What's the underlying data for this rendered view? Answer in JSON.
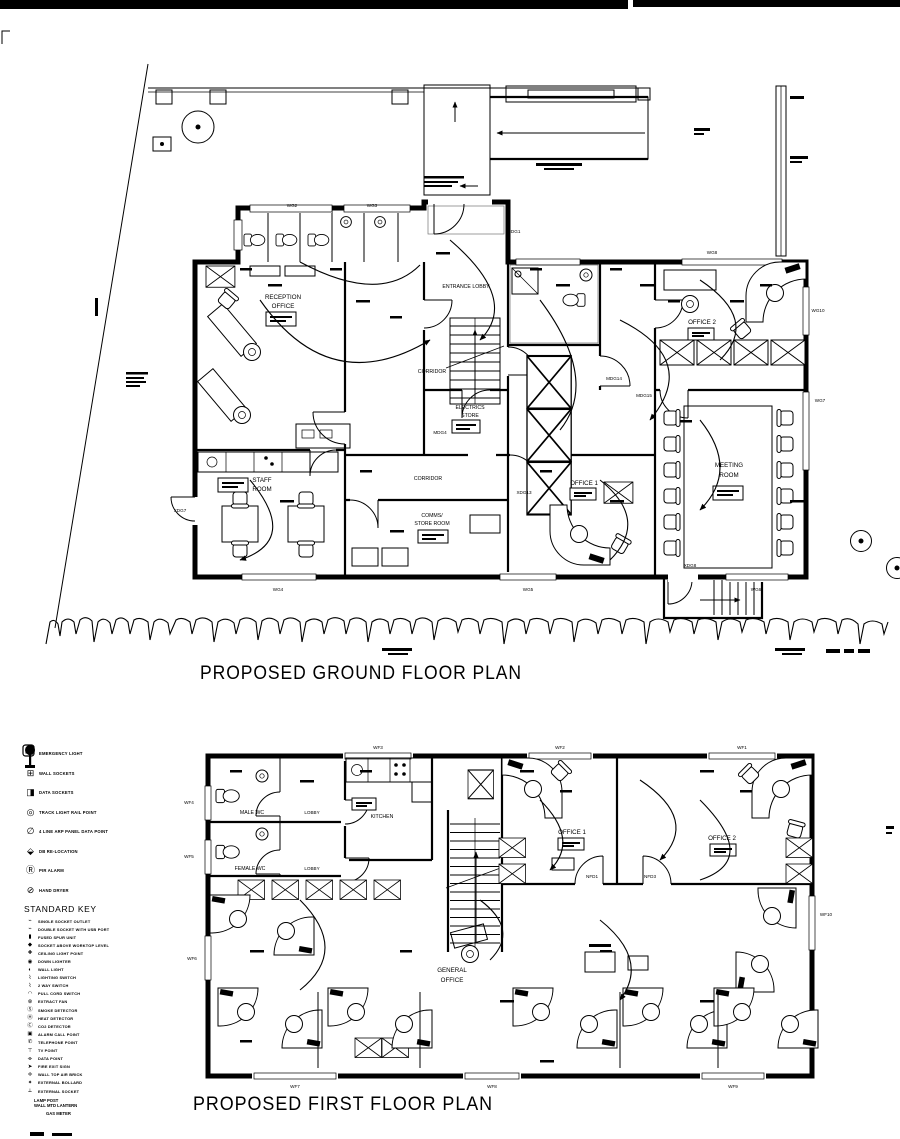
{
  "titles": {
    "ground": "PROPOSED GROUND FLOOR PLAN",
    "first": "PROPOSED FIRST FLOOR PLAN"
  },
  "colors": {
    "ink": "#000000",
    "paper": "#ffffff",
    "grid": "#9a9a9a"
  },
  "ground_floor": {
    "rooms": {
      "reception": {
        "line1": "RECEPTION",
        "line2": "OFFICE"
      },
      "entrance_lobby": {
        "line1": "ENTRANCE LOBBY"
      },
      "corridor_upper": {
        "line1": "CORRIDOR"
      },
      "electrics_store": {
        "line1": "ELECTRICS",
        "line2": "STORE"
      },
      "office2": {
        "line1": "OFFICE 2"
      },
      "meeting": {
        "line1": "MEETING",
        "line2": "ROOM"
      },
      "staff": {
        "line1": "STAFF",
        "line2": "ROOM"
      },
      "corridor_lower": {
        "line1": "CORRIDOR"
      },
      "comms": {
        "line1": "COMMS/",
        "line2": "STORE ROOM"
      },
      "office1": {
        "line1": "OFFICE 1"
      }
    },
    "doors": {
      "d1": "XDG7",
      "d2": "MDG4",
      "d3": "MDG14",
      "d4": "MDG15",
      "d5": "XDG13",
      "d6": "XDG8",
      "d7": "NDG1"
    },
    "windows": {
      "w2": "WG2",
      "w3": "WG3",
      "w4": "WG4",
      "w5": "WG5",
      "w6": "WG6",
      "w7": "WG7",
      "w8": "WG8",
      "w10": "WG10"
    }
  },
  "first_floor": {
    "rooms": {
      "male_wc": {
        "line1": "MALE WC"
      },
      "lobby_m": {
        "line1": "LOBBY"
      },
      "female_wc": {
        "line1": "FEMALE WC"
      },
      "lobby_f": {
        "line1": "LOBBY"
      },
      "kitchen": {
        "line1": "KITCHEN"
      },
      "office1": {
        "line1": "OFFICE 1"
      },
      "office2": {
        "line1": "OFFICE 2"
      },
      "general": {
        "line1": "GENERAL",
        "line2": "OFFICE"
      }
    },
    "doors": {
      "d1": "NFD1",
      "d2": "NFD3"
    },
    "windows": {
      "w1": "WF1",
      "w2": "WF2",
      "w3": "WF3",
      "w4": "WF4",
      "w5": "WF5",
      "w6": "WF6",
      "w7": "WF7",
      "w8": "WF8",
      "w9": "WF9",
      "w10": "WF10"
    }
  },
  "legend": {
    "heading": "STANDARD KEY",
    "upper": [
      {
        "glyph": "✸",
        "label": "EMERGENCY LIGHT"
      },
      {
        "glyph": "⊞",
        "label": "WALL SOCKETS"
      },
      {
        "glyph": "◨",
        "label": "DATA SOCKETS"
      },
      {
        "glyph": "◎",
        "label": "TRACK LIGHT RAIL POINT"
      },
      {
        "glyph": "∅",
        "label": "4 LINE ARP PANEL DATA POINT"
      },
      {
        "glyph": "⬙",
        "label": "DB RE-LOCATION"
      },
      {
        "glyph": "Ⓡ",
        "label": "PIR ALARM"
      },
      {
        "glyph": "⊘",
        "label": "HAND DRYER"
      }
    ],
    "items": [
      {
        "glyph": "⌁",
        "label": "SINGLE SOCKET OUTLET"
      },
      {
        "glyph": "⌁",
        "label": "DOUBLE SOCKET WITH USB PORT"
      },
      {
        "glyph": "▮",
        "label": "FUSED SPUR UNIT"
      },
      {
        "glyph": "◆",
        "label": "SOCKET ABOVE WORKTOP LEVEL"
      },
      {
        "glyph": "✚",
        "label": "CEILING LIGHT POINT"
      },
      {
        "glyph": "◉",
        "label": "DOWN LIGHTER"
      },
      {
        "glyph": "◐",
        "label": "WALL LIGHT"
      },
      {
        "glyph": "⌇",
        "label": "LIGHTING SWITCH"
      },
      {
        "glyph": "⌇",
        "label": "2 WAY SWITCH"
      },
      {
        "glyph": "◠",
        "label": "PULL CORD SWITCH"
      },
      {
        "glyph": "⊗",
        "label": "EXTRACT FAN"
      },
      {
        "glyph": "Ⓢ",
        "label": "SMOKE DETECTOR"
      },
      {
        "glyph": "Ⓗ",
        "label": "HEAT DETECTOR"
      },
      {
        "glyph": "Ⓒ",
        "label": "CO2 DETECTOR"
      },
      {
        "glyph": "▣",
        "label": "ALARM CALL POINT"
      },
      {
        "glyph": "✆",
        "label": "TELEPHONE POINT"
      },
      {
        "glyph": "⊤",
        "label": "TV POINT"
      },
      {
        "glyph": "⌯",
        "label": "DATA POINT"
      },
      {
        "glyph": "➤",
        "label": "FIRE EXIT SIGN"
      },
      {
        "glyph": "✛",
        "label": "WALL TOP AIR BRICK"
      },
      {
        "glyph": "✦",
        "label": "EXTERNAL BOLLARD"
      },
      {
        "glyph": "⟂",
        "label": "EXTERNAL SOCKET"
      }
    ],
    "lamp": {
      "label1": "LAMP POST",
      "label2": "WALL MTD LANTERN"
    },
    "meter": {
      "label": "GAS METER"
    }
  }
}
